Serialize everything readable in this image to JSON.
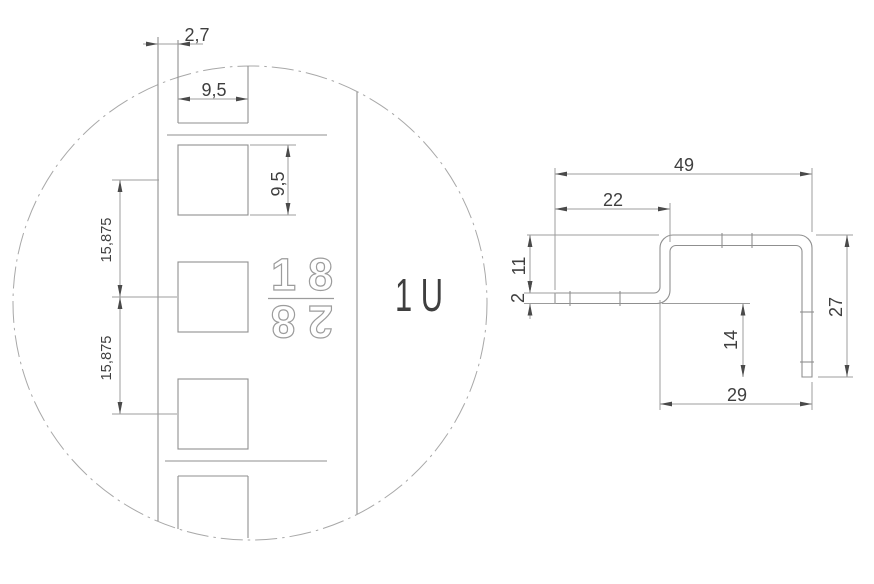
{
  "colors": {
    "background": "#ffffff",
    "object_line": "#8f8f8f",
    "dimension_line": "#9c9c9c",
    "centerline": "#a8a8a8",
    "text": "#3f3f3f",
    "outline_text": "#9c9c9c",
    "arrow": "#4a4a4a"
  },
  "detail_view": {
    "unit_label": "1 U",
    "rail_marking_top": "18",
    "rail_marking_bottom": "28",
    "dims": {
      "edge_offset": "2,7",
      "hole_width": "9,5",
      "hole_height": "9,5",
      "hole_pitch_upper": "15,875",
      "hole_pitch_lower": "15,875"
    }
  },
  "profile_view": {
    "dims": {
      "overall_width": "49",
      "top_flange_width": "22",
      "offset_height": "11",
      "material_thickness": "2",
      "overall_height": "27",
      "front_leg_height": "14",
      "bottom_width": "29"
    }
  }
}
